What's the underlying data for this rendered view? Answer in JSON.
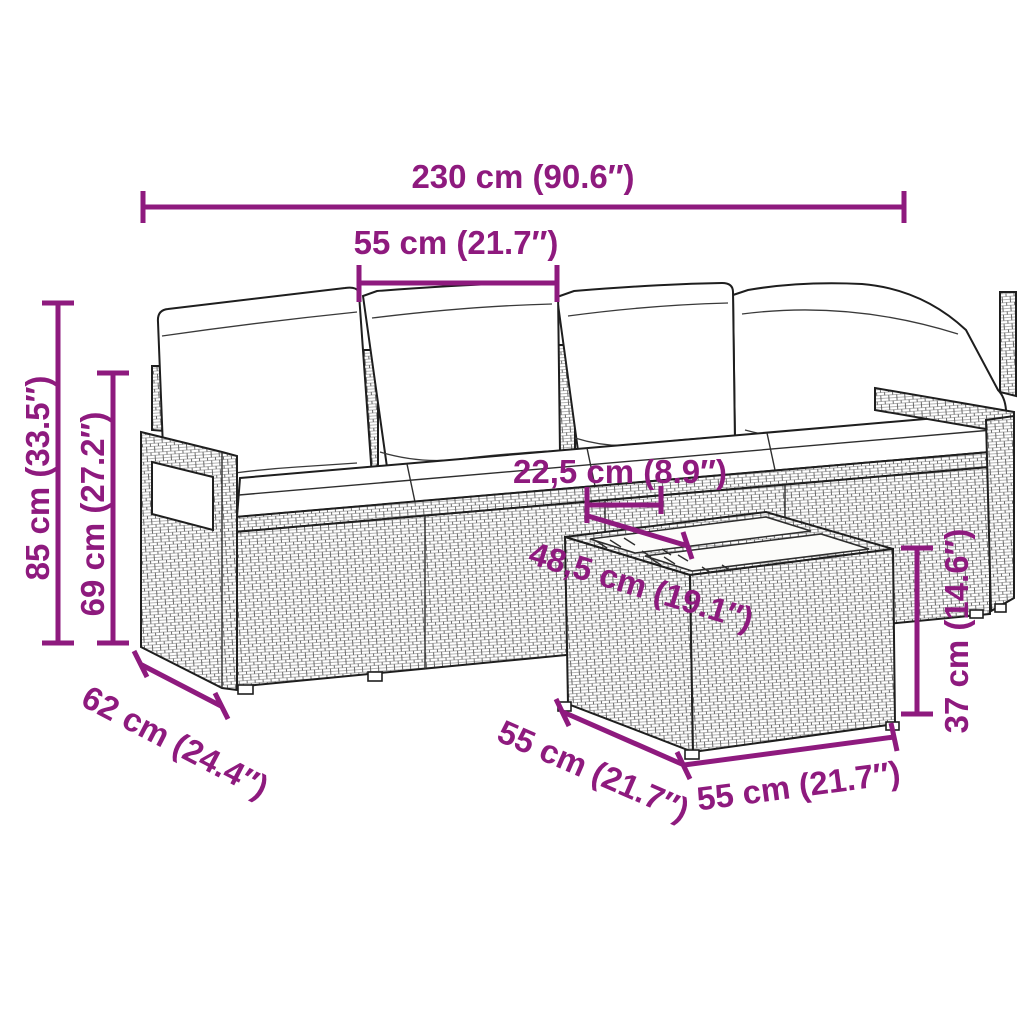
{
  "page": {
    "background": "#ffffff",
    "type": "product dimension diagram"
  },
  "style": {
    "dimension_color": "#8E1A7E",
    "outline_color": "#1e1e1e",
    "rattan_texture_color": "#5d5d5d",
    "cushion_color": "#ffffff"
  },
  "figure": {
    "description": "Line drawing of a poly rattan garden sofa set: a four-seat modular sofa with back cushions, seat cushions and armrests, plus a square rattan side table with a two-panel glass top",
    "pieces": [
      "4-seat rattan sofa with white cushions",
      "square rattan table with glass top"
    ]
  },
  "dimensions": [
    {
      "id": "total-width",
      "label": "230 cm (90.6″)",
      "orientation": "horizontal"
    },
    {
      "id": "seat-width",
      "label": "55 cm (21.7″)",
      "orientation": "horizontal"
    },
    {
      "id": "total-height",
      "label": "85 cm (33.5″)",
      "orientation": "vertical"
    },
    {
      "id": "backrest-height",
      "label": "69 cm (27.2″)",
      "orientation": "vertical"
    },
    {
      "id": "seat-depth",
      "label": "62 cm (24.4″)",
      "orientation": "diagonal"
    },
    {
      "id": "table-offset",
      "label": "22,5 cm (8.9″)",
      "orientation": "horizontal"
    },
    {
      "id": "table-top-depth",
      "label": "48,5 cm (19.1″)",
      "orientation": "diagonal"
    },
    {
      "id": "table-side-length",
      "label": "55 cm (21.7″)",
      "orientation": "diagonal"
    },
    {
      "id": "table-front-length",
      "label": "55 cm (21.7″)",
      "orientation": "diagonal"
    },
    {
      "id": "table-height",
      "label": "37 cm (14.6″)",
      "orientation": "vertical"
    }
  ]
}
